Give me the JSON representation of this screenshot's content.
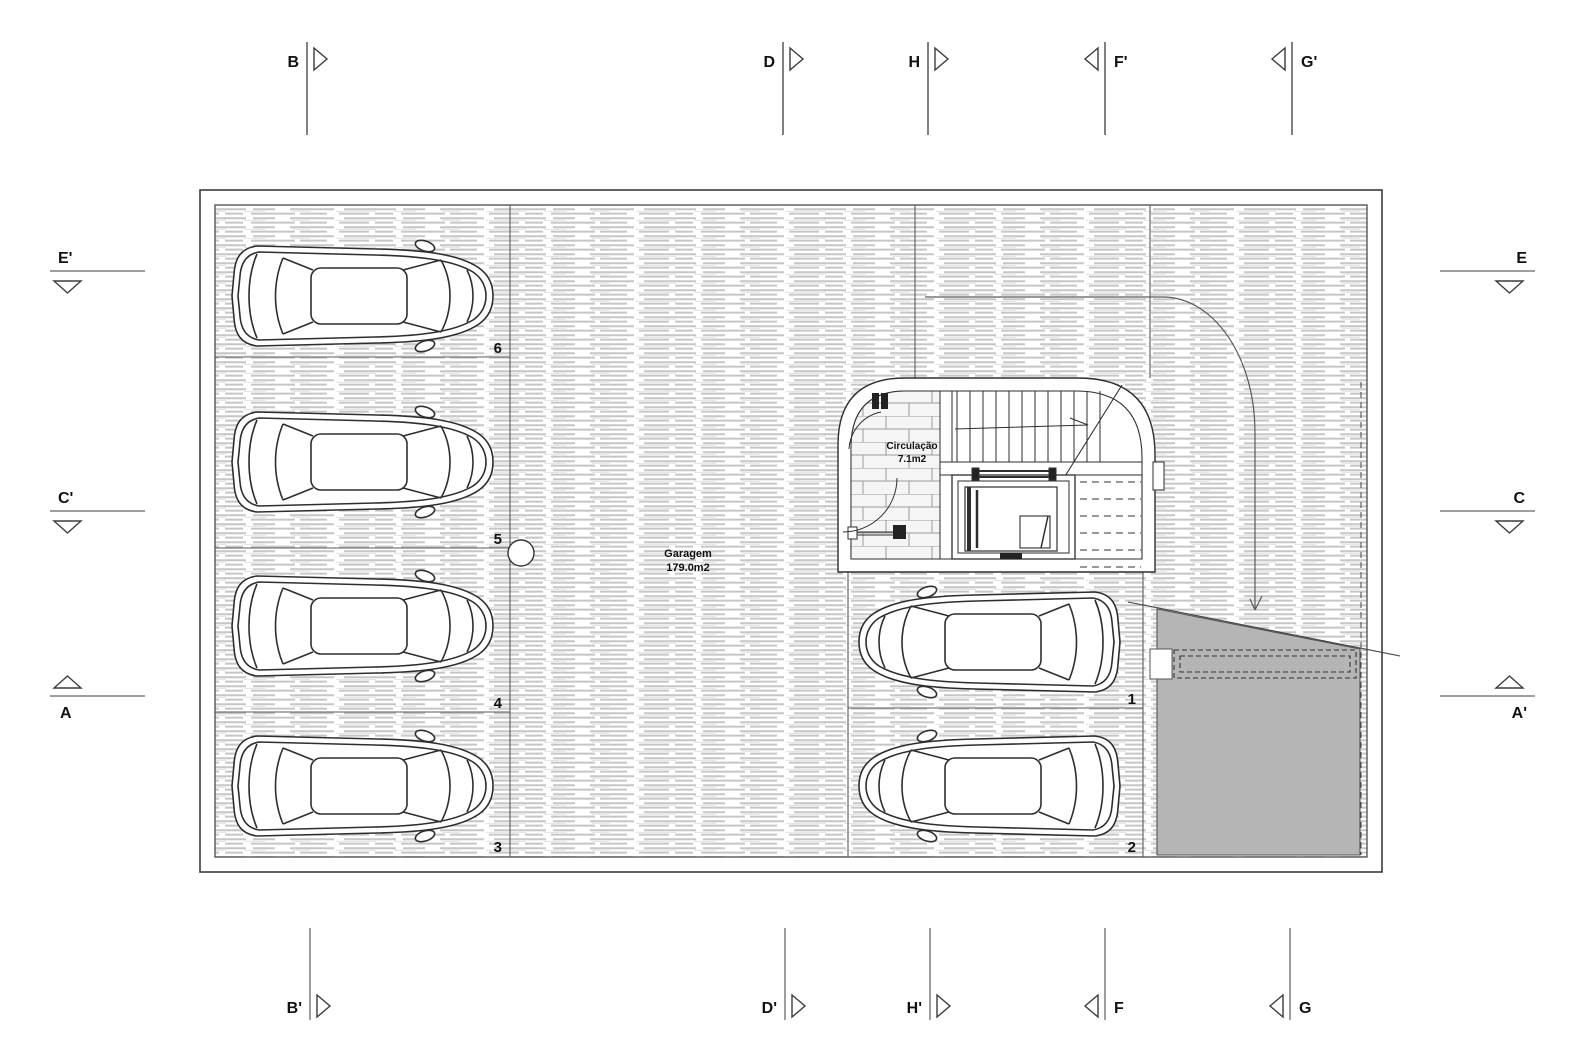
{
  "drawing": {
    "type": "architectural-floor-plan",
    "rooms": [
      {
        "name": "Garagem",
        "area": "179.0m2"
      },
      {
        "name": "Circulação",
        "area": "7.1m2"
      }
    ],
    "parking_spaces": [
      "1",
      "2",
      "3",
      "4",
      "5",
      "6"
    ],
    "section_markers": {
      "top": [
        {
          "label": "B"
        },
        {
          "label": "D"
        },
        {
          "label": "H"
        },
        {
          "label": "F'"
        },
        {
          "label": "G'"
        }
      ],
      "bottom": [
        {
          "label": "B'"
        },
        {
          "label": "D'"
        },
        {
          "label": "H'"
        },
        {
          "label": "F"
        },
        {
          "label": "G"
        }
      ],
      "left": [
        {
          "label": "E'"
        },
        {
          "label": "C'"
        },
        {
          "label": "A"
        }
      ],
      "right": [
        {
          "label": "E"
        },
        {
          "label": "C"
        },
        {
          "label": "A'"
        }
      ]
    },
    "colors": {
      "ramp_fill": "#b5b5b5",
      "hatch_line": "#c6c6c6",
      "line": "#3c3c3c"
    }
  }
}
